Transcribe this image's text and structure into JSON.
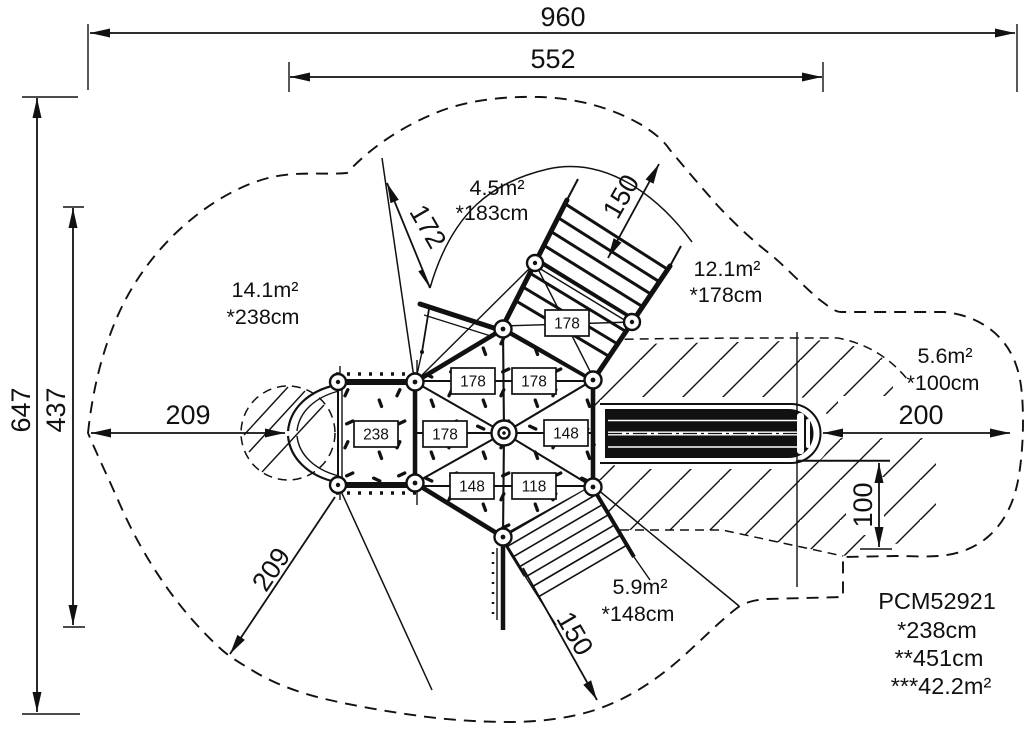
{
  "dimensions": {
    "overall_width": "960",
    "inner_width": "552",
    "overall_depth": "647",
    "inner_depth": "437",
    "left_clearance": "209",
    "diagonal_clearance": "209",
    "upper_left_zone": "172",
    "upper_right_zone": "150",
    "lower_zone": "150",
    "right_clearance": "200",
    "slide_side": "100"
  },
  "zones": {
    "left": {
      "area": "14.1m²",
      "height": "*238cm"
    },
    "top": {
      "area": "4.5m²",
      "height": "*183cm"
    },
    "top_right": {
      "area": "12.1m²",
      "height": "*178cm"
    },
    "right": {
      "area": "5.6m²",
      "height": "*100cm"
    },
    "bottom": {
      "area": "5.9m²",
      "height": "*148cm"
    }
  },
  "platform_heights": {
    "boxes": [
      "178",
      "178",
      "178",
      "238",
      "178",
      "148",
      "148",
      "118"
    ]
  },
  "info_block": {
    "lines": [
      "PCM52921",
      "*238cm",
      "**451cm",
      "***42.2m²"
    ]
  }
}
